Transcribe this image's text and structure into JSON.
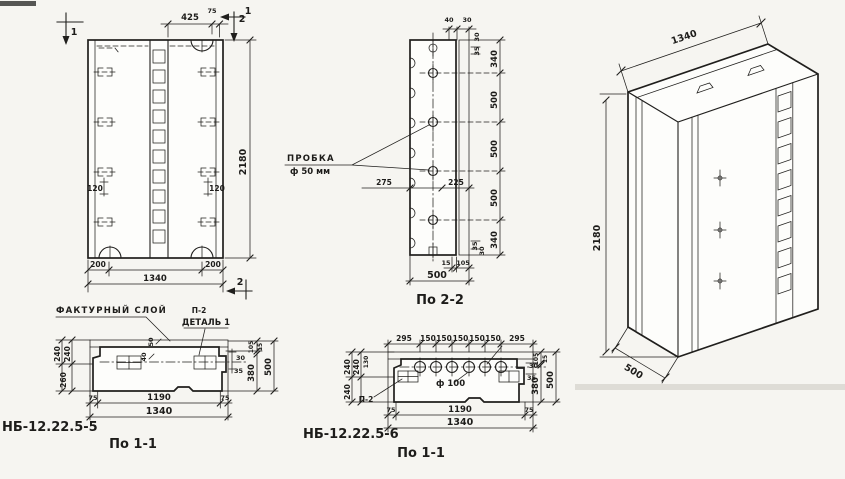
{
  "drawing": {
    "elevation": {
      "marker_1_left": "1",
      "marker_1_right": "1",
      "marker_2_top": "2",
      "marker_2_bottom": "2",
      "dim_top_width": "425",
      "dim_top_offset": "75",
      "dim_height": "2180",
      "dim_edge_left": "200",
      "dim_edge_right": "200",
      "dim_total_width": "1340",
      "dim_loop_left": "120",
      "dim_loop_right": "120"
    },
    "section_1_1_left": {
      "part_number": "НБ-12.22.5-5",
      "caption": "По 1-1",
      "callout_facade_layer": "ФАКТУРНЫЙ СЛОЙ",
      "callout_p2": "П-2",
      "callout_detail": "ДЕТАЛЬ 1",
      "dim_50": "50",
      "dim_40": "40",
      "dim_240_a": "240",
      "dim_240_b": "240",
      "dim_260": "260",
      "dim_30": "30",
      "dim_35": "35",
      "dim_105": "105",
      "dim_15": "15",
      "dim_380": "380",
      "dim_500": "500",
      "dim_75_left": "75",
      "dim_1190": "1190",
      "dim_75_right": "75",
      "dim_1340": "1340"
    },
    "section_2_2": {
      "caption": "По 2-2",
      "callout_plug": "ПРОБКА",
      "callout_plug_dia": "ф 50 мм",
      "dim_40": "40",
      "dim_30_top": "30",
      "dim_30_right_top": "30",
      "dim_35_right_top": "35",
      "height_chain": [
        "340",
        "500",
        "500",
        "500",
        "340"
      ],
      "dim_275": "275",
      "dim_225": "225",
      "dim_35_right_bottom": "35",
      "dim_30_right_bottom": "30",
      "dim_15": "15",
      "dim_105": "105",
      "dim_500": "500"
    },
    "section_1_1_right": {
      "part_number": "НБ-12.22.5-6",
      "caption": "По 1-1",
      "callout_p2": "П-2",
      "callout_dia": "ф 100",
      "top_chain": [
        "295",
        "150",
        "150",
        "150",
        "150",
        "150",
        "295"
      ],
      "dim_240_a": "240",
      "dim_240_b": "240",
      "dim_130": "130",
      "dim_240_c": "240",
      "dim_30": "30",
      "dim_35": "35",
      "dim_105": "105",
      "dim_15": "15",
      "dim_380": "380",
      "dim_500": "500",
      "dim_75_left": "75",
      "dim_1190": "1190",
      "dim_75_right": "75",
      "dim_1340": "1340"
    },
    "isometric": {
      "dim_width": "1340",
      "dim_height": "2180",
      "dim_depth": "500"
    }
  }
}
